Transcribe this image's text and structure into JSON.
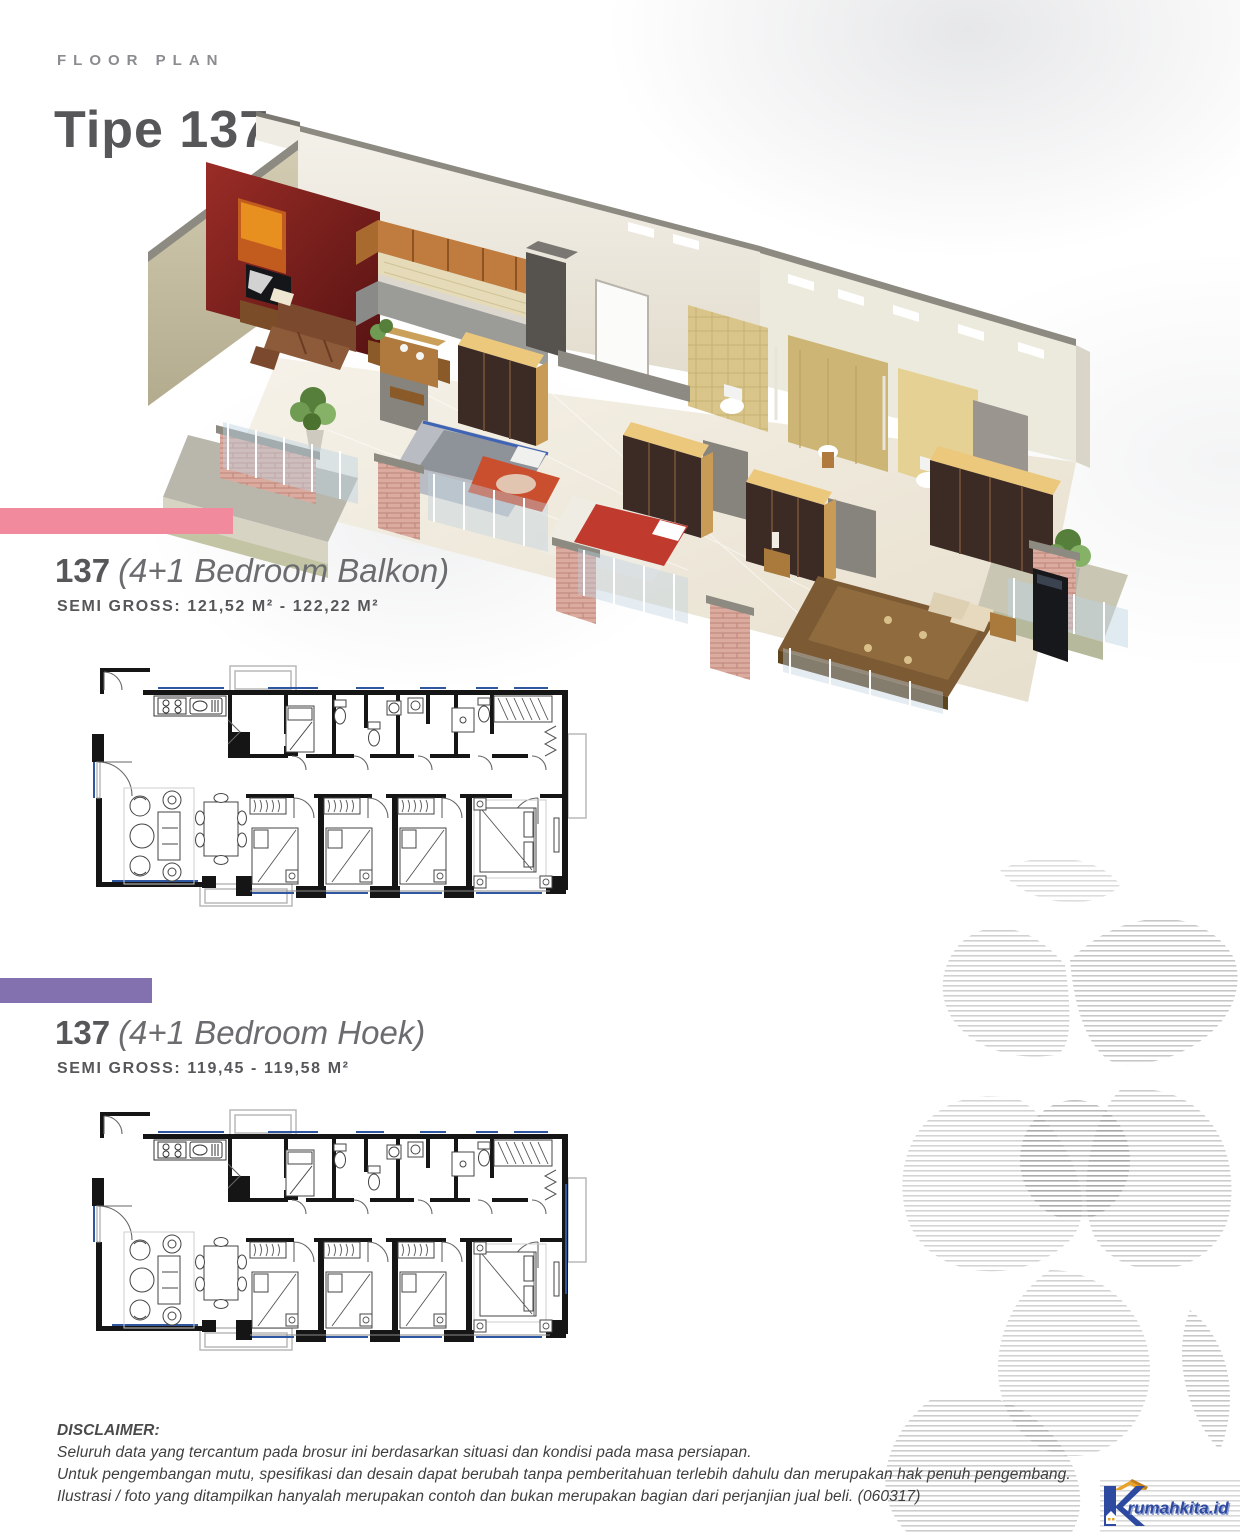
{
  "page": {
    "eyebrow": "FLOOR PLAN",
    "title": "Tipe 137"
  },
  "sections": [
    {
      "number": "137",
      "name": "(4+1 Bedroom Balkon)",
      "semi_gross_label": "SEMI GROSS:",
      "semi_gross_value": "121,52 M² - 122,22 M²",
      "bar_color": "#f28a9e"
    },
    {
      "number": "137",
      "name": "(4+1 Bedroom Hoek)",
      "semi_gross_label": "SEMI GROSS:",
      "semi_gross_value": "119,45 - 119,58 M²",
      "bar_color": "#8270af"
    }
  ],
  "disclaimer": {
    "heading": "DISCLAIMER:",
    "lines": [
      "Seluruh data yang tercantum pada brosur ini berdasarkan situasi dan kondisi pada masa persiapan.",
      "Untuk pengembangan mutu, spesifikasi dan desain dapat berubah tanpa pemberitahuan terlebih dahulu dan merupakan hak penuh pengembang.",
      "Ilustrasi / foto yang ditampilkan hanyalah merupakan contoh dan bukan merupakan bagian dari perjanjian jual beli. (060317)"
    ]
  },
  "logo": {
    "brand": "rumahkita.id"
  },
  "colors": {
    "accent_pink": "#f28a9e",
    "accent_purple": "#8270af",
    "title_gray": "#57575a",
    "eyebrow_gray": "#8a8c8f",
    "body_gray": "#3f3f3f",
    "plan_wall_black": "#151515",
    "plan_window_blue": "#2f56a0",
    "render_red_wall": "#7e2220",
    "render_wood_cabinet": "#c07c3e",
    "render_wardrobe_top": "#ecc87d",
    "render_brick": "#d8a49a",
    "logo_blue": "#2e49a0",
    "logo_orange": "#e8a32a"
  }
}
